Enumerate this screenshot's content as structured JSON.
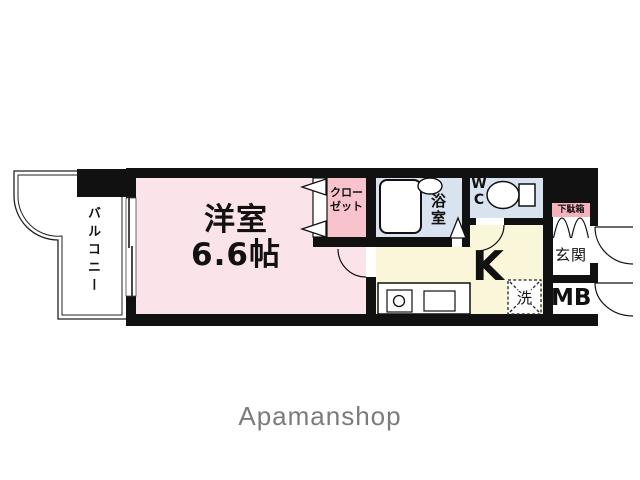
{
  "colors": {
    "room_pink": "#fbe4e9",
    "closet_pink": "#f8c3cc",
    "water_blue": "#d9e3f0",
    "kitchen_yellow": "#faf6d9",
    "label_pink": "#f5b2bc",
    "wall_black": "#111111",
    "logo_gray": "#7b7b7b"
  },
  "floorplan": {
    "balcony": {
      "label": "バルコニー"
    },
    "main_room": {
      "name": "洋室",
      "size": "6.6帖"
    },
    "closet": {
      "label_line1": "クロー",
      "label_line2": "ゼット"
    },
    "bathroom": {
      "label": "浴室"
    },
    "toilet": {
      "label": "WC"
    },
    "kitchen": {
      "label": "K"
    },
    "laundry": {
      "label": "洗"
    },
    "shoe_cabinet": {
      "label": "下駄箱"
    },
    "entrance": {
      "label": "玄関"
    },
    "meter_box": {
      "label": "MB"
    }
  },
  "branding": {
    "logo_text": "Apamanshop"
  }
}
